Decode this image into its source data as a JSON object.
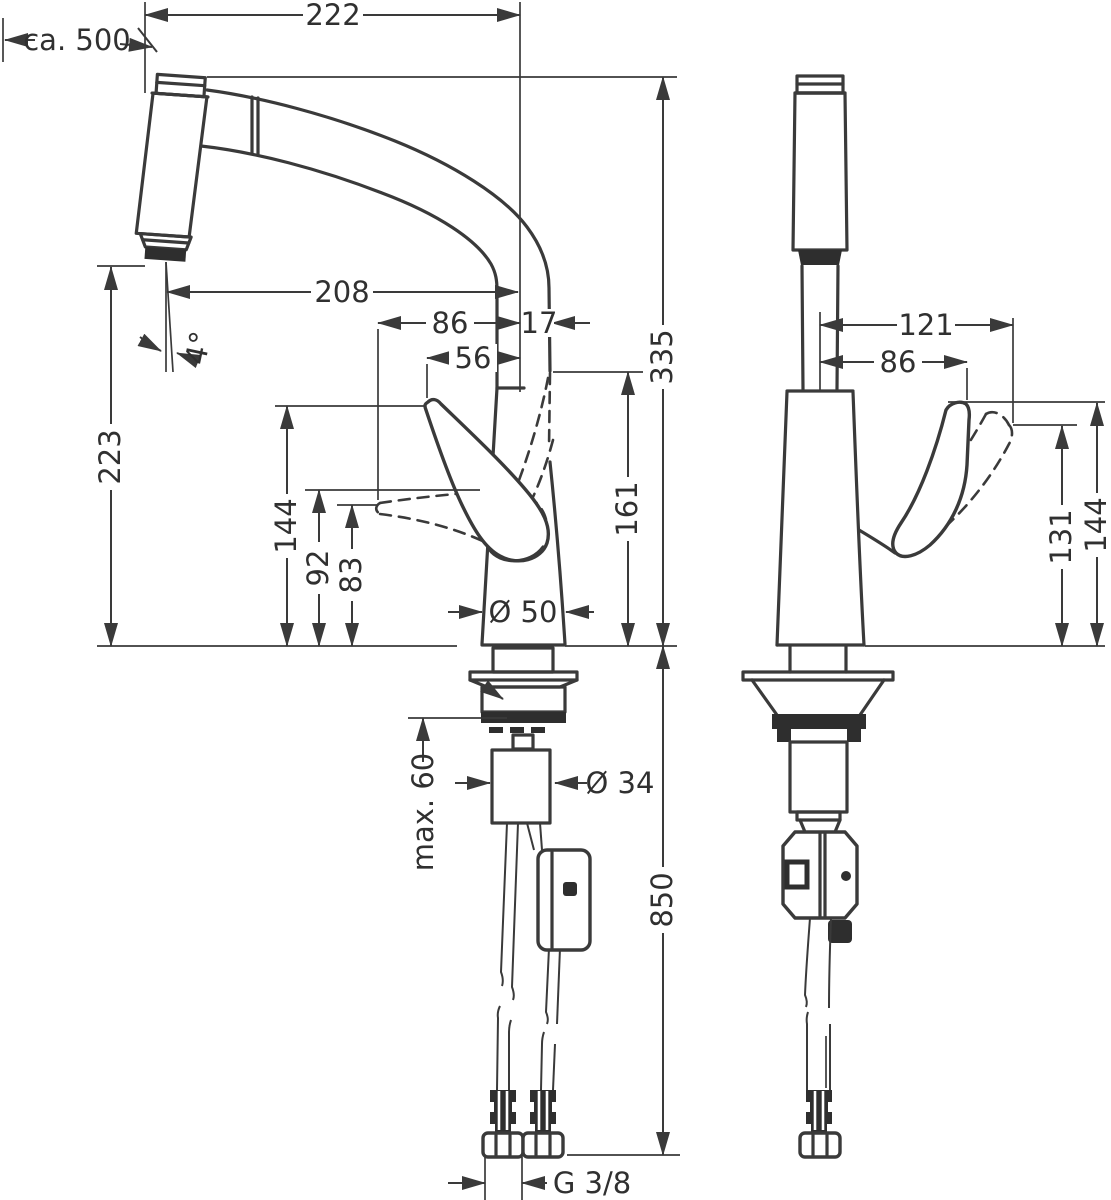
{
  "drawing": {
    "kind": "faucet installation dimension drawing, two views",
    "dims": {
      "top_width": "222",
      "pullout_length": "ca. 500",
      "outlet_reach": "208",
      "side_86": "86",
      "side_17": "17",
      "side_56": "56",
      "angle": "4°",
      "outlet_height": "223",
      "side_144": "144",
      "side_92": "92",
      "side_83": "83",
      "side_161": "161",
      "total_height": "335",
      "base_dia": "Ø 50",
      "max_thickness": "max. 60",
      "shank_dia": "Ø 34",
      "hose_length": "850",
      "thread": "G 3/8",
      "front_121": "121",
      "front_86": "86",
      "front_131": "131",
      "front_144": "144"
    }
  }
}
